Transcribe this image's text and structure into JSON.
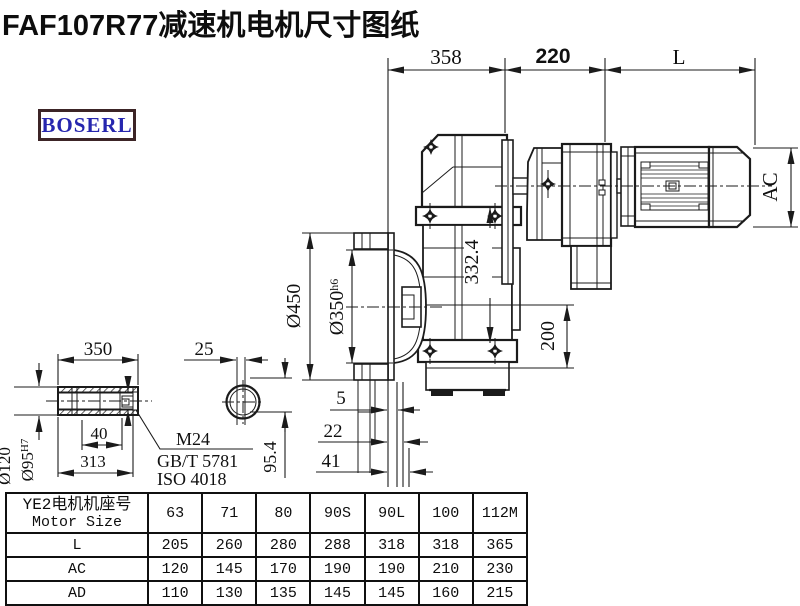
{
  "title": "FAF107R77减速机电机尺寸图纸",
  "logo": "BOSERL",
  "colors": {
    "line": "#1b1b1b",
    "logo_border": "#3c2426",
    "logo_text": "#2626ae",
    "title_text": "#0d0d0d"
  },
  "dims": {
    "top_358": "358",
    "top_220": "220",
    "top_L": "L",
    "ac": "AC",
    "d450": "Ø450",
    "d350": "Ø350",
    "d350_tol": "h6",
    "v332": "332.4",
    "v200": "200",
    "off5": "5",
    "off22": "22",
    "off41": "41",
    "v95": "95.4",
    "shaft350": "350",
    "shaft25": "25",
    "d120": "Ø120",
    "d95": "Ø95",
    "d95_tol": "H7",
    "len40": "40",
    "len313": "313",
    "thread": "M24",
    "std1": "GB/T 5781",
    "std2": "ISO 4018"
  },
  "table": {
    "header": {
      "cn": "YE2电机机座号",
      "en": "Motor Size"
    },
    "columns": [
      "63",
      "71",
      "80",
      "90S",
      "90L",
      "100",
      "112M"
    ],
    "rows": [
      {
        "label": "L",
        "values": [
          "205",
          "260",
          "280",
          "288",
          "318",
          "318",
          "365"
        ]
      },
      {
        "label": "AC",
        "values": [
          "120",
          "145",
          "170",
          "190",
          "190",
          "210",
          "230"
        ]
      },
      {
        "label": "AD",
        "values": [
          "110",
          "130",
          "135",
          "145",
          "145",
          "160",
          "215"
        ]
      }
    ]
  }
}
